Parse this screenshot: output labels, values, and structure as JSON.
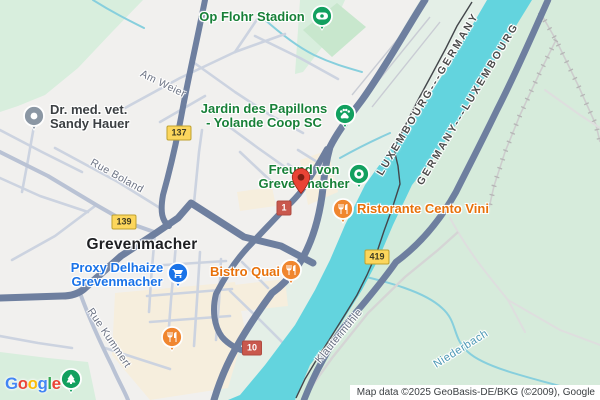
{
  "city": {
    "label": "Grevenmacher"
  },
  "pois": {
    "op_flohr": {
      "label": "Op Flohr Stadion"
    },
    "jardin": {
      "line1": "Jardin des Papillons",
      "line2": "- Yolande Coop SC"
    },
    "vet": {
      "line1": "Dr. med. vet.",
      "line2": "Sandy Hauer"
    },
    "freund": {
      "line1": "Freund von",
      "line2": "Grevenmacher"
    },
    "ristorante": {
      "label": "Ristorante Cento Vini"
    },
    "bistro": {
      "label": "Bistro Quai"
    },
    "proxy": {
      "line1": "Proxy Delhaize",
      "line2": "Grevenmacher"
    }
  },
  "streets": {
    "am_weier": "Am Weier",
    "rue_boland": "Rue Boland",
    "rue_kummert": "Rue Kummert",
    "klautermuehle": "Klautermühle"
  },
  "water": {
    "niederbach": "Niederbach"
  },
  "border_labels": {
    "lux_de": "LUXEMBOURG---GERMANY",
    "de_lux": "GERMANY---LUXEMBOURG"
  },
  "route_badges": {
    "b137": "137",
    "b139": "139",
    "b419": "419",
    "b1": "1",
    "b10": "10"
  },
  "attribution": "Map data ©2025 GeoBasis-DE/BKG (©2009), Google",
  "logo": {
    "letters": [
      {
        "ch": "G",
        "color": "#4285F4"
      },
      {
        "ch": "o",
        "color": "#EA4335"
      },
      {
        "ch": "o",
        "color": "#FBBC05"
      },
      {
        "ch": "g",
        "color": "#4285F4"
      },
      {
        "ch": "l",
        "color": "#34A853"
      },
      {
        "ch": "e",
        "color": "#EA4335"
      }
    ]
  },
  "colors": {
    "water": "#63d4de",
    "park_green": "#d8eedd",
    "germany_fields": "#d6ebdb",
    "town_beige": "#f6eedd",
    "road_major": "#6e7f9f",
    "road_minor": "#ccd3e0",
    "poi_green": "#12a05f",
    "poi_orange": "#f0862f",
    "poi_blue": "#1a73e8",
    "poi_gray": "#8b97a4",
    "pin_red": "#EA4335",
    "badge_yellow": "#fcd65c",
    "badge_red": "#c9584d"
  }
}
